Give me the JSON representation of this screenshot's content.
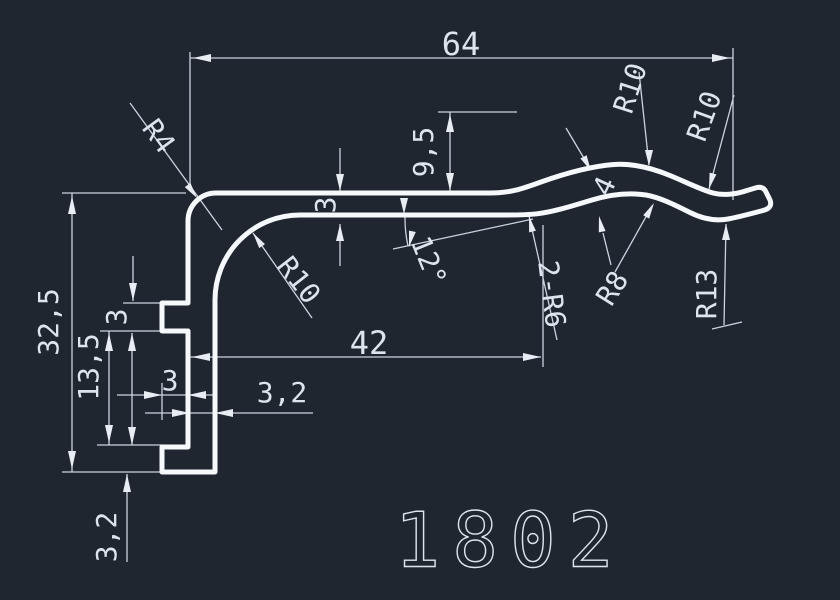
{
  "drawing": {
    "part_number": "1802",
    "colors": {
      "background": "#1f2630",
      "profile_line": "#f6f9fc",
      "dimension_line": "#ccd4e0",
      "text": "#dde4ee"
    },
    "dims": {
      "total_width": "64",
      "total_height": "32,5",
      "mid_height": "13,5",
      "rib_height": "3",
      "rib_depth": "3",
      "wall_thickness": "3,2",
      "foot_height": "3,2",
      "arm_length": "42",
      "arm_thickness": "3",
      "crest_offset": "9,5",
      "wave_thickness": "4",
      "ramp_angle": "12°"
    },
    "radii": {
      "corner": "R4",
      "inner_corner": "R10",
      "crest": "R10",
      "outer_right": "R10",
      "under_crest": "R8",
      "tip": "R13",
      "ramp_fillets": "2-R6"
    }
  }
}
